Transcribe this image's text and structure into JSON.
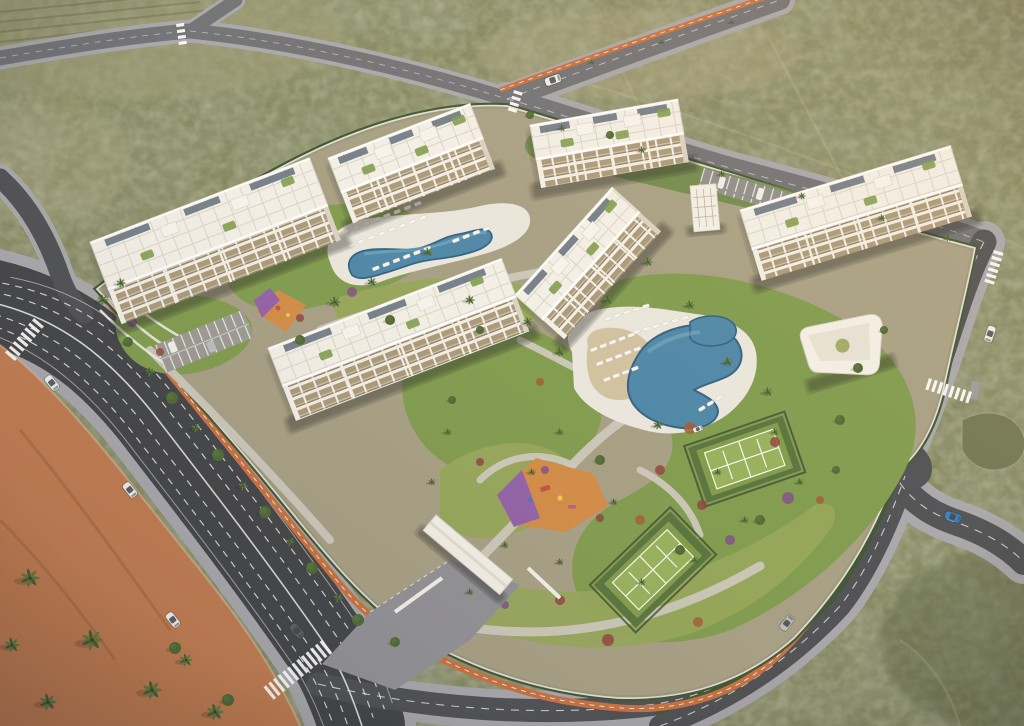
{
  "scene": {
    "kind": "aerial-architectural-render",
    "time_of_day": "dusk"
  },
  "palette": {
    "scrub": "#7e8159",
    "scrubDark": "#57603f",
    "scrubLight": "#9d9b76",
    "sand": "#b0a884",
    "asphalt": "#3f4145",
    "asphaltMid": "#4b4d52",
    "roadFaint": "#6e6f74",
    "lane": "#e9e9e7",
    "bike": "#c56f3e",
    "sidewalk": "#a6a6ab",
    "pavers": "#8f8f94",
    "esplanade": "#bf7a4e",
    "siteBase": "#a59e83",
    "lawn": "#7d9a4c",
    "lawnLight": "#93a558",
    "lawnDark": "#62823d",
    "hedge": "#3c5231",
    "wall": "#f2f0e8",
    "deck": "#eae7de",
    "sandBeach": "#cfc1a0",
    "building": "#f3f0e8",
    "buildingShade": "#d9d2c4",
    "facade": "#a89878",
    "roofLine": "#d9d5ca",
    "solar": "#5a6a79",
    "poolDark": "#2e5f80",
    "pool": "#4a85a8",
    "poolLight": "#79b1c6",
    "courtApron": "#55713b",
    "court": "#7d9a47",
    "courtIn": "#95af59",
    "fence": "#39482e",
    "playOrange": "#d18a44",
    "playPurple": "#8f5fa8",
    "flowerRed": "#8e413c",
    "flowerPurple": "#7c4f86",
    "flowerRust": "#a05a35",
    "palm": "#3f5c2e",
    "palmLight": "#5a7a3a",
    "tree": "#4a6633",
    "carWhite": "#eef0ee",
    "carSilver": "#b9bcc0",
    "carBlue": "#2e7fc2",
    "carDark": "#5a5c60",
    "glass": "#3a4048",
    "shadow": "rgba(30,32,24,0.38)"
  },
  "objects": {
    "buildings": [
      {
        "id": "building-c",
        "x": 530,
        "y": 125,
        "angle": -10,
        "len": 150,
        "wid": 36,
        "fac": 28
      },
      {
        "id": "building-b",
        "x": 328,
        "y": 158,
        "angle": -21,
        "len": 152,
        "wid": 38,
        "fac": 32
      },
      {
        "id": "building-d",
        "x": 740,
        "y": 210,
        "angle": -17,
        "len": 220,
        "wid": 42,
        "fac": 32
      },
      {
        "id": "building-a",
        "x": 90,
        "y": 242,
        "angle": -21,
        "len": 235,
        "wid": 52,
        "fac": 36
      },
      {
        "id": "building-e",
        "x": 515,
        "y": 295,
        "angle": -48,
        "len": 145,
        "wid": 38,
        "fac": 28
      },
      {
        "id": "building-f",
        "x": 268,
        "y": 348,
        "angle": -21,
        "len": 250,
        "wid": 42,
        "fac": 36
      }
    ],
    "palms": [
      [
        30,
        578,
        10
      ],
      [
        92,
        640,
        11
      ],
      [
        152,
        690,
        10
      ],
      [
        215,
        712,
        9
      ],
      [
        48,
        702,
        9
      ],
      [
        12,
        645,
        8
      ],
      [
        186,
        660,
        7
      ],
      [
        103,
        300,
        6
      ],
      [
        121,
        283,
        5
      ],
      [
        150,
        372,
        5
      ],
      [
        196,
        428,
        5
      ],
      [
        243,
        486,
        5
      ],
      [
        290,
        542,
        5
      ],
      [
        338,
        598,
        5
      ],
      [
        335,
        302,
        6
      ],
      [
        372,
        282,
        5
      ],
      [
        428,
        252,
        5
      ],
      [
        470,
        300,
        5
      ],
      [
        528,
        322,
        5
      ],
      [
        560,
        352,
        5
      ],
      [
        608,
        300,
        5
      ],
      [
        648,
        262,
        5
      ],
      [
        690,
        305,
        5
      ],
      [
        728,
        362,
        5
      ],
      [
        768,
        392,
        5
      ],
      [
        658,
        425,
        5
      ],
      [
        560,
        432,
        4
      ],
      [
        448,
        432,
        4
      ],
      [
        432,
        482,
        4
      ],
      [
        532,
        472,
        4
      ],
      [
        614,
        502,
        4
      ],
      [
        560,
        562,
        4
      ],
      [
        642,
        582,
        4
      ],
      [
        718,
        472,
        4
      ],
      [
        775,
        432,
        4
      ],
      [
        800,
        482,
        4
      ],
      [
        505,
        545,
        4
      ],
      [
        470,
        592,
        4
      ],
      [
        695,
        560,
        4
      ],
      [
        745,
        520,
        4
      ],
      [
        562,
        128,
        4
      ],
      [
        642,
        150,
        4
      ],
      [
        722,
        174,
        4
      ],
      [
        802,
        196,
        4
      ],
      [
        882,
        218,
        4
      ],
      [
        948,
        238,
        4
      ],
      [
        592,
        62,
        3
      ],
      [
        662,
        42,
        3
      ],
      [
        732,
        22,
        3
      ]
    ],
    "trees": [
      [
        172,
        398,
        6
      ],
      [
        218,
        455,
        6
      ],
      [
        265,
        512,
        6
      ],
      [
        312,
        568,
        6
      ],
      [
        358,
        620,
        6
      ],
      [
        128,
        342,
        5
      ],
      [
        175,
        648,
        6
      ],
      [
        228,
        700,
        6
      ],
      [
        395,
        642,
        5
      ],
      [
        300,
        340,
        5
      ],
      [
        390,
        320,
        5
      ],
      [
        600,
        460,
        5
      ],
      [
        680,
        550,
        5
      ],
      [
        760,
        520,
        5
      ],
      [
        840,
        420,
        5
      ],
      [
        858,
        368,
        5
      ],
      [
        480,
        330,
        4
      ],
      [
        452,
        400,
        4
      ],
      [
        530,
        115,
        4
      ],
      [
        610,
        135,
        4
      ],
      [
        836,
        470,
        4
      ],
      [
        884,
        330,
        4
      ]
    ],
    "cars": [
      {
        "x": 52,
        "y": 383,
        "a": 51,
        "c": "carWhite"
      },
      {
        "x": 130,
        "y": 490,
        "a": 51,
        "c": "carWhite"
      },
      {
        "x": 173,
        "y": 620,
        "a": 51,
        "c": "carWhite"
      },
      {
        "x": 297,
        "y": 631,
        "a": 48,
        "c": "carDark"
      },
      {
        "x": 990,
        "y": 334,
        "a": 108,
        "c": "carWhite"
      },
      {
        "x": 953,
        "y": 517,
        "a": 18,
        "c": "carBlue"
      },
      {
        "x": 787,
        "y": 623,
        "a": -52,
        "c": "carSilver"
      },
      {
        "x": 553,
        "y": 80,
        "a": -20,
        "c": "carWhite"
      },
      {
        "x": 698,
        "y": 429,
        "a": -20,
        "c": "carWhite",
        "s": 0.6
      }
    ],
    "loungerRows": [
      {
        "x": 342,
        "y": 231,
        "a": -21,
        "n": 8,
        "s": 11
      },
      {
        "x": 347,
        "y": 245,
        "a": -21,
        "n": 8,
        "s": 11
      },
      {
        "x": 372,
        "y": 268,
        "a": -21,
        "n": 6,
        "s": 11
      },
      {
        "x": 452,
        "y": 240,
        "a": -21,
        "n": 4,
        "s": 11
      },
      {
        "x": 590,
        "y": 349,
        "a": -21,
        "n": 5,
        "s": 10
      },
      {
        "x": 596,
        "y": 363,
        "a": -21,
        "n": 5,
        "s": 10
      },
      {
        "x": 603,
        "y": 379,
        "a": -21,
        "n": 4,
        "s": 10
      },
      {
        "x": 633,
        "y": 331,
        "a": -16,
        "n": 6,
        "s": 10
      },
      {
        "x": 604,
        "y": 318,
        "a": -18,
        "n": 5,
        "s": 10
      },
      {
        "x": 698,
        "y": 409,
        "a": -32,
        "n": 3,
        "s": 10
      }
    ],
    "flowers": [
      [
        690,
        428,
        6,
        "flowerRust"
      ],
      [
        775,
        442,
        5,
        "flowerRed"
      ],
      [
        702,
        505,
        5,
        "flowerRed"
      ],
      [
        788,
        498,
        6,
        "flowerPurple"
      ],
      [
        640,
        520,
        5,
        "flowerRust"
      ],
      [
        600,
        518,
        4,
        "flowerRed"
      ],
      [
        608,
        640,
        6,
        "flowerRed"
      ],
      [
        698,
        622,
        5,
        "flowerRust"
      ],
      [
        545,
        470,
        4,
        "flowerPurple"
      ],
      [
        480,
        462,
        4,
        "flowerRed"
      ],
      [
        352,
        292,
        5,
        "flowerPurple"
      ],
      [
        470,
        278,
        4,
        "flowerRust"
      ],
      [
        132,
        322,
        5,
        "flowerPurple"
      ],
      [
        160,
        352,
        4,
        "flowerRed"
      ],
      [
        540,
        382,
        4,
        "flowerRust"
      ],
      [
        660,
        470,
        5,
        "flowerRed"
      ],
      [
        730,
        540,
        5,
        "flowerPurple"
      ],
      [
        820,
        500,
        4,
        "flowerRust"
      ],
      [
        560,
        600,
        5,
        "flowerRed"
      ],
      [
        505,
        605,
        4,
        "flowerPurple"
      ],
      [
        420,
        300,
        4,
        "flowerRust"
      ],
      [
        300,
        318,
        4,
        "flowerRed"
      ]
    ],
    "zebras": [
      {
        "x": 322,
        "y": 640,
        "a": 51,
        "n": 13,
        "l": 16
      },
      {
        "x": 34,
        "y": 318,
        "a": 40,
        "n": 8,
        "l": 13
      },
      {
        "x": 972,
        "y": 392,
        "a": 108,
        "n": 8,
        "l": 12
      },
      {
        "x": 994,
        "y": 250,
        "a": 17,
        "n": 6,
        "l": 10
      },
      {
        "x": 514,
        "y": 90,
        "a": 17,
        "n": 4,
        "l": 9
      },
      {
        "x": 176,
        "y": 24,
        "a": -8,
        "n": 4,
        "l": 8
      }
    ]
  }
}
